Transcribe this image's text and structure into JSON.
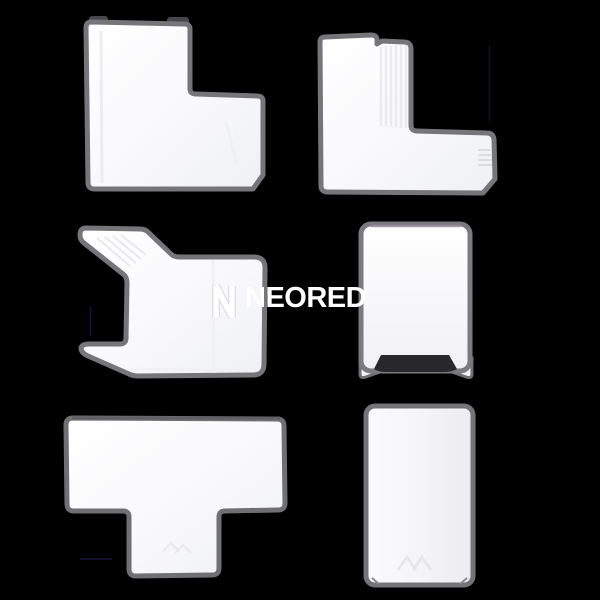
{
  "image": {
    "kind": "product-photo",
    "description": "Six white PVC cable trunking accessories on a black background",
    "background_color": "#000000"
  },
  "watermark": {
    "logo_icon": "neored-n-monogram",
    "text": "NEORED",
    "text_color": "#ffffff"
  },
  "products": [
    {
      "position": "top-left",
      "shape": "flat-angle-fitting"
    },
    {
      "position": "top-right",
      "shape": "elbow-l-fitting"
    },
    {
      "position": "middle-left",
      "shape": "internal-corner-fitting"
    },
    {
      "position": "middle-right",
      "shape": "end-cap-fitting"
    },
    {
      "position": "bottom-left",
      "shape": "tee-junction-fitting"
    },
    {
      "position": "bottom-right",
      "shape": "straight-coupler-fitting"
    }
  ],
  "colors": {
    "piece_fill": "#fbfbfd",
    "piece_outline": "#75757a",
    "dark_inset": "#28282c",
    "top_tint": "#9e8fa4",
    "artifact_line": "#15153a"
  }
}
